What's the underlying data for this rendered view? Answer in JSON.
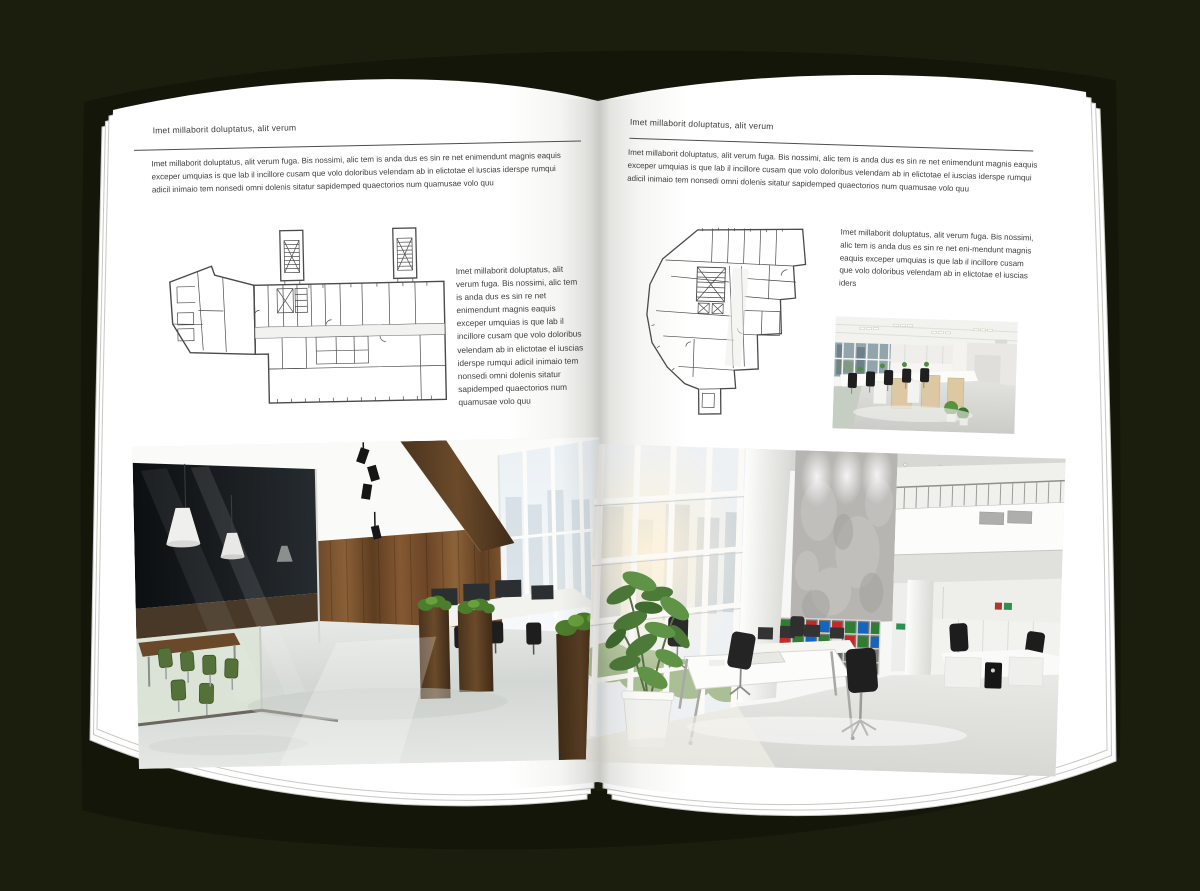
{
  "document": {
    "kind": "open magazine spread mockup"
  },
  "colors": {
    "background": "#1b1e0d",
    "cover": "#141609",
    "page": "#ffffff",
    "text": "#3c3c3c",
    "rule": "#4e4e4e",
    "plan_line": "#4a4a4a",
    "wood_light": "#8a5f36",
    "wood_dark": "#4b351f",
    "grass": "#4e7d2e",
    "chair_green": "#54713a",
    "binder_green": "#2e7d32",
    "binder_red": "#c62828",
    "binder_blue": "#1565c0",
    "exit_green": "#2f8f4f"
  },
  "left_page": {
    "header": "Imet millaborit doluptatus, alit verum",
    "intro": "Imet millaborit doluptatus, alit verum fuga. Bis nossimi, alic tem is anda dus es sin re net enimendunt magnis eaquis exceper umquias is que lab il incillore cusam que volo doloribus velendam ab in elictotae el iuscias iderspe rumqui adicil inimaio tem nonsedi omni dolenis sitatur sapidemped quaectorios num quamusae volo quu",
    "caption": "Imet millaborit doluptatus, alit verum fuga. Bis nossimi, alic tem is anda dus es sin re net enimendunt magnis eaquis exceper umquias is que lab il incillore cusam que volo doloribus velendam ab in elictotae el iuscias iderspe rumqui adicil inimaio tem nonsedi omni dolenis sitatur sapidemped quaectorios num quamusae volo quu",
    "figures": {
      "floor_plan_alt": "architectural floor plan drawing, elongated building with two stair towers",
      "photo_alt": "dark loft office interior with wood wall, glass meeting room and green chairs"
    }
  },
  "right_page": {
    "header": "Imet millaborit doluptatus, alit verum",
    "intro": "Imet millaborit doluptatus, alit verum fuga. Bis nossimi, alic tem is anda dus es sin re net enimendunt magnis eaquis exceper umquias is que lab il incillore cusam que volo doloribus velendam ab in elictotae el iuscias iderspe rumqui adicil inimaio tem nonsedi omni dolenis sitatur sapidemped quaectorios num quamusae volo quu",
    "caption": "Imet millaborit doluptatus, alit verum fuga. Bis nossimi, alic tem is anda dus es sin re net eni-mendunt magnis eaquis exceper umquias is que lab il incillore cusam que volo doloribus velendam ab in elictotae el iuscias iders",
    "figures": {
      "floor_plan_alt": "architectural floor plan drawing, irregular building outline with stair core",
      "photo_small_alt": "open space office with rows of desks and black chairs",
      "photo_alt": "bright white atrium office with tall windows, concrete wall and bookshelf"
    }
  }
}
